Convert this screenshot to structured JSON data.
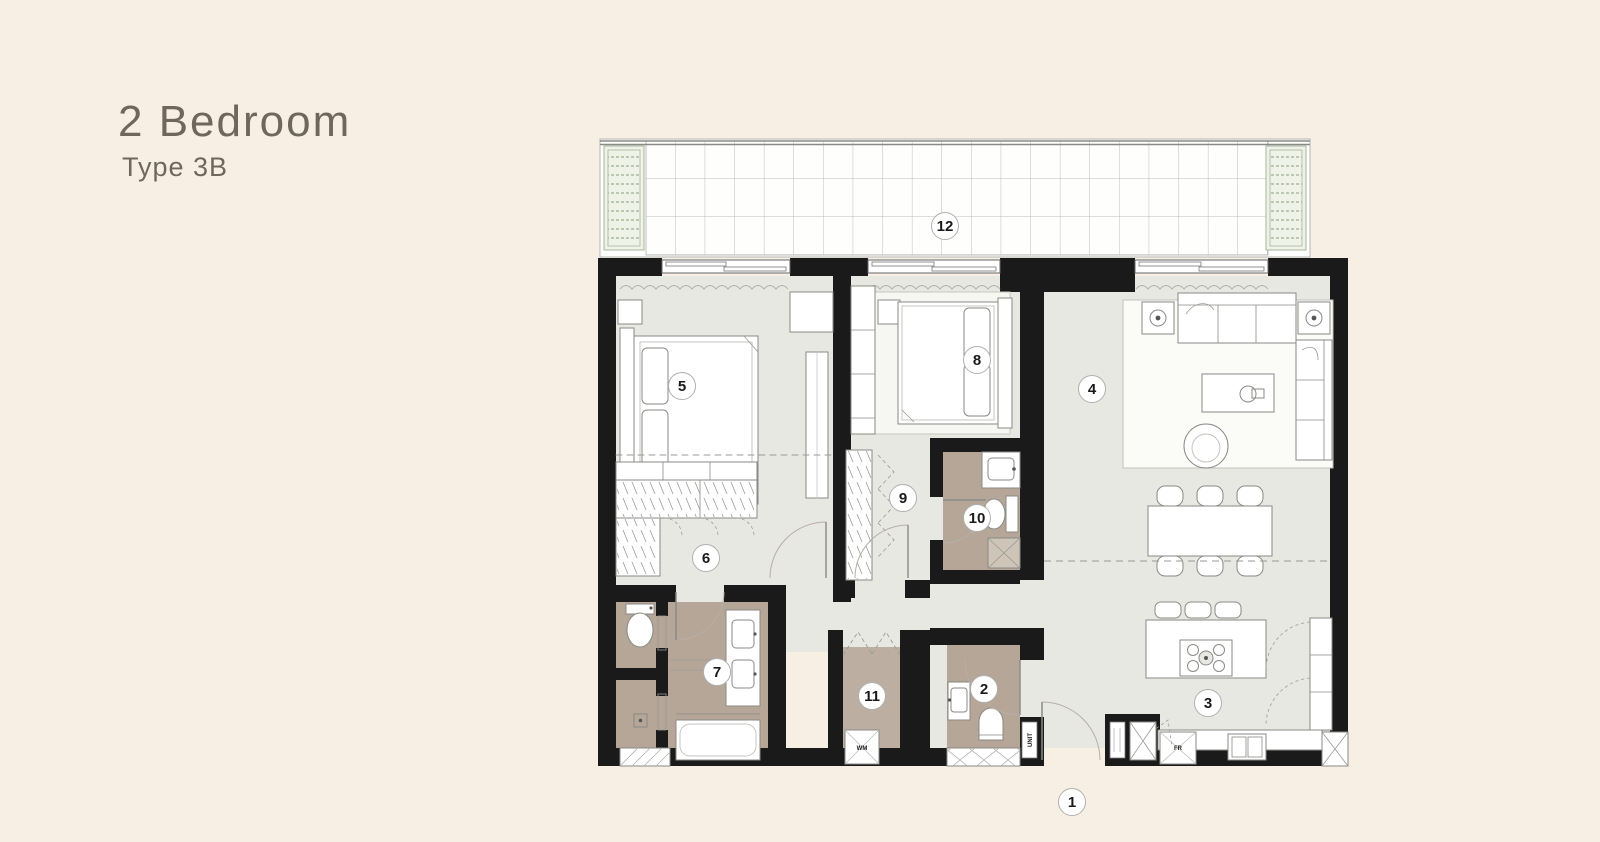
{
  "title": {
    "heading": "2 Bedroom",
    "subheading": "Type 3B"
  },
  "rooms": [
    {
      "number": "1"
    },
    {
      "number": "2"
    },
    {
      "number": "3"
    },
    {
      "number": "4"
    },
    {
      "number": "5"
    },
    {
      "number": "6"
    },
    {
      "number": "7"
    },
    {
      "number": "8"
    },
    {
      "number": "9"
    },
    {
      "number": "10"
    },
    {
      "number": "11"
    },
    {
      "number": "12"
    }
  ],
  "appliances": {
    "washing_machine": "WM",
    "fridge": "FR",
    "service_shaft": "UNIT"
  },
  "colors": {
    "background": "#f7efe4",
    "floor": "#e8e8e2",
    "wet_room_floor": "#b5a698",
    "wall": "#1a1a1a",
    "planter_green": "#9fae93"
  }
}
